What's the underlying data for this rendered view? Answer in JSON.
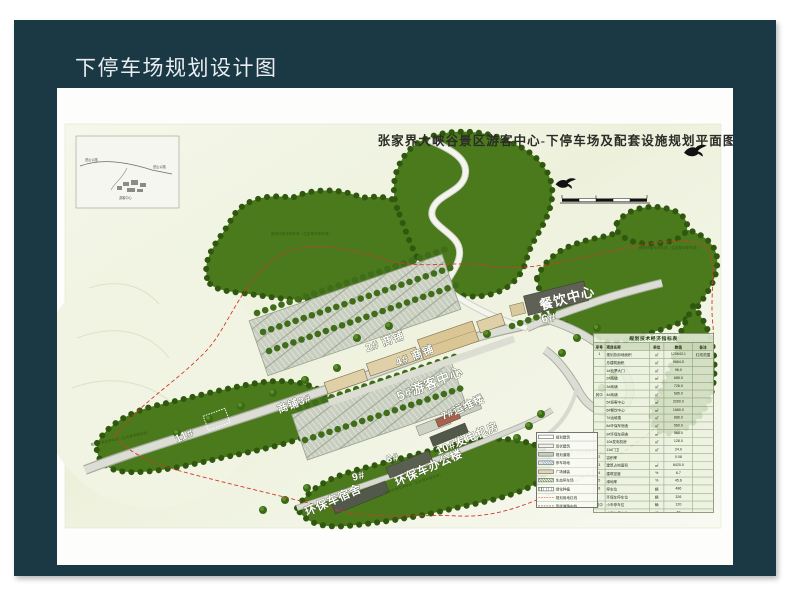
{
  "slide": {
    "title": "下停车场规划设计图"
  },
  "map": {
    "title": "张家界大峡谷景区游客中心-下停车场及配套设施规划平面图",
    "labels": [
      "餐饮中心",
      "6#",
      "2# 商铺",
      "4# 商铺",
      "5#游客中心",
      "7#运维楼",
      "10#发电机房",
      "商铺3#",
      "8#",
      "9#",
      "环保车宿舍",
      "环保车办公楼",
      "11#"
    ],
    "annotations": [
      "规划环保车停车场（生态草坪停车场）",
      "规划环保车停车场（生态草坪停车场）",
      "规划环保车停车场（生态草坪停车场）",
      "规划环保车停车场（生态草坪停车场）",
      "规划环保车停车场（生态草坪停车场）"
    ],
    "inset": {
      "labels": [
        "进山公路",
        "进山公路",
        "游客中心"
      ]
    },
    "table": {
      "title": "规划技术经济指标表",
      "headers": [
        "序号",
        "项目名称",
        "单位",
        "数值",
        "备注"
      ],
      "rows": [
        [
          "1",
          "规划总用地面积",
          "㎡",
          "125643.1",
          "红线范围"
        ],
        [
          "",
          "总建筑面积",
          "㎡",
          "9664.5",
          ""
        ],
        [
          "",
          "1#检票大门",
          "㎡",
          "96.0",
          ""
        ],
        [
          "",
          "2#商铺",
          "㎡",
          "685.0",
          ""
        ],
        [
          "",
          "3#商铺",
          "㎡",
          "726.0",
          ""
        ],
        [
          "其中",
          "4#商铺",
          "㎡",
          "685.0",
          ""
        ],
        [
          "",
          "5#游客中心",
          "㎡",
          "3260.0",
          ""
        ],
        [
          "",
          "6#餐饮中心",
          "㎡",
          "1680.0",
          ""
        ],
        [
          "",
          "7#运维楼",
          "㎡",
          "886.0",
          ""
        ],
        [
          "",
          "8#环保车宿舍",
          "㎡",
          "560.0",
          ""
        ],
        [
          "",
          "9#环保车宿舍",
          "㎡",
          "560.0",
          ""
        ],
        [
          "",
          "10#发电机房",
          "㎡",
          "128.0",
          ""
        ],
        [
          "",
          "11#门卫",
          "㎡",
          "24.0",
          ""
        ],
        [
          "2",
          "容积率",
          "",
          "0.08",
          ""
        ],
        [
          "3",
          "建筑占地面积",
          "㎡",
          "8420.0",
          ""
        ],
        [
          "4",
          "建筑密度",
          "%",
          "6.7",
          ""
        ],
        [
          "5",
          "绿地率",
          "%",
          "45.6",
          ""
        ],
        [
          "6",
          "停车位",
          "辆",
          "486",
          ""
        ],
        [
          "",
          "环保车停车位",
          "辆",
          "326",
          ""
        ],
        [
          "其中",
          "小车停车位",
          "辆",
          "120",
          ""
        ],
        [
          "",
          "大巴车停车位",
          "辆",
          "40",
          ""
        ]
      ]
    },
    "legend": {
      "items": [
        {
          "swatch": "solid-white",
          "label": "规划建筑"
        },
        {
          "swatch": "solid-white2",
          "label": "现状建筑"
        },
        {
          "swatch": "solid-gray",
          "label": "规划道路"
        },
        {
          "swatch": "hatch-blue",
          "label": "停车场地"
        },
        {
          "swatch": "solid-tan",
          "label": "广场铺装"
        },
        {
          "swatch": "hatch-green",
          "label": "生态停车场"
        },
        {
          "swatch": "lines-green",
          "label": "绿化种植"
        },
        {
          "swatch": "dash-red",
          "label": "规划用地红线"
        },
        {
          "swatch": "dash-dark",
          "label": "现状道路中线"
        }
      ]
    },
    "colors": {
      "frame_navy": "#1b3845",
      "forest_green": "#4b7a1d",
      "boundary_red": "#d03a28",
      "building_tan": "#dfd0a8"
    }
  }
}
